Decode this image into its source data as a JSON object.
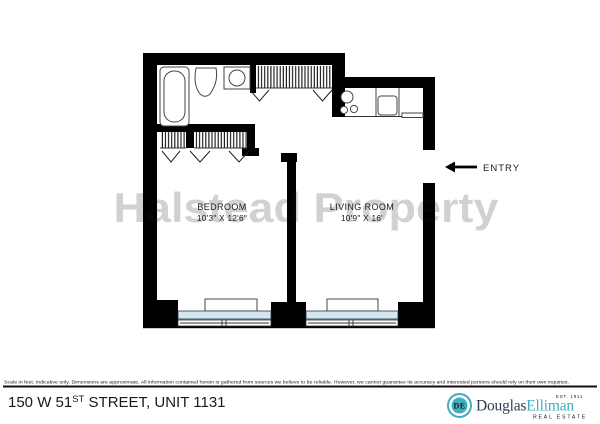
{
  "floorplan": {
    "watermark": "Halstead Property",
    "entry_label": "ENTRY",
    "rooms": [
      {
        "name": "BEDROOM",
        "dimensions": "10'3\" X 12'6\""
      },
      {
        "name": "LIVING ROOM",
        "dimensions": "10'9\" X 16'"
      }
    ],
    "fixtures": [
      "bathtub-icon",
      "toilet-icon",
      "bathroom-sink-icon",
      "closet-hatch",
      "door-swing-icon",
      "stove-burners-icon",
      "kitchen-sink-icon",
      "dishwasher-icon",
      "radiator",
      "window",
      "entry-arrow-icon"
    ],
    "colors": {
      "wall": "#000000",
      "window_glass": "#cfe8f4",
      "watermark": "rgba(0,0,0,0.2)"
    }
  },
  "footer": {
    "disclaimer": "Scale in feet. Indicative only. Dimensions are approximate. All information contained herein is gathered from sources we believe to be reliable. However, we cannot guarantee its accuracy and interested persons should rely on their own inquiries.",
    "address": {
      "prefix": "150 W 51",
      "superscript": "ST",
      "suffix": " STREET, UNIT 1131"
    },
    "logo": {
      "monogram": "DE",
      "name_first": "Douglas",
      "name_second": "Elliman",
      "established": "EST. 1911",
      "tagline": "REAL ESTATE",
      "teal": "#3fafc0",
      "navy": "#2e3d4f"
    }
  }
}
